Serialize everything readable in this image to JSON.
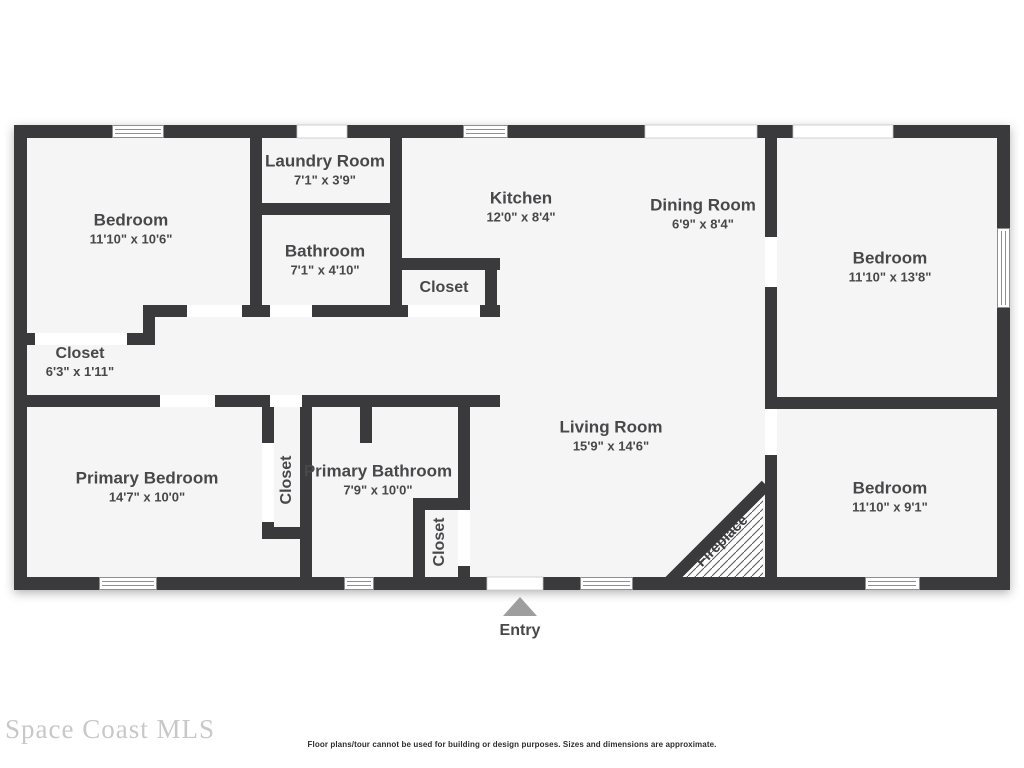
{
  "floor_plan": {
    "rooms": [
      {
        "name": "Bedroom",
        "dims": "11'10\" x 10'6\""
      },
      {
        "name": "Laundry Room",
        "dims": "7'1\" x 3'9\""
      },
      {
        "name": "Bathroom",
        "dims": "7'1\" x 4'10\""
      },
      {
        "name": "Closet",
        "dims": ""
      },
      {
        "name": "Kitchen",
        "dims": "12'0\" x 8'4\""
      },
      {
        "name": "Dining Room",
        "dims": "6'9\" x 8'4\""
      },
      {
        "name": "Bedroom",
        "dims": "11'10\" x 13'8\""
      },
      {
        "name": "Closet",
        "dims": "6'3\" x 1'11\""
      },
      {
        "name": "Primary Bedroom",
        "dims": "14'7\" x 10'0\""
      },
      {
        "name": "Closet",
        "dims": ""
      },
      {
        "name": "Primary Bathroom",
        "dims": "7'9\" x 10'0\""
      },
      {
        "name": "Closet",
        "dims": ""
      },
      {
        "name": "Living Room",
        "dims": "15'9\" x 14'6\""
      },
      {
        "name": "Bedroom",
        "dims": "11'10\" x 9'1\""
      }
    ],
    "features": {
      "fireplace": "Fireplace",
      "entry": "Entry"
    }
  },
  "footer": {
    "watermark": "Space Coast MLS",
    "disclaimer": "Floor plans/tour cannot be used for building or design purposes. Sizes and dimensions are approximate."
  },
  "colors": {
    "wall": "#3a3a3c",
    "floor": "#f5f5f6",
    "gap": "#ffffff",
    "label": "#48484a",
    "win-line": "#8f8f8f",
    "watermark": "#c8c8c8",
    "entry": "#9e9e9e",
    "disclaimer": "#2e2e2e",
    "hatch": "#555555"
  }
}
